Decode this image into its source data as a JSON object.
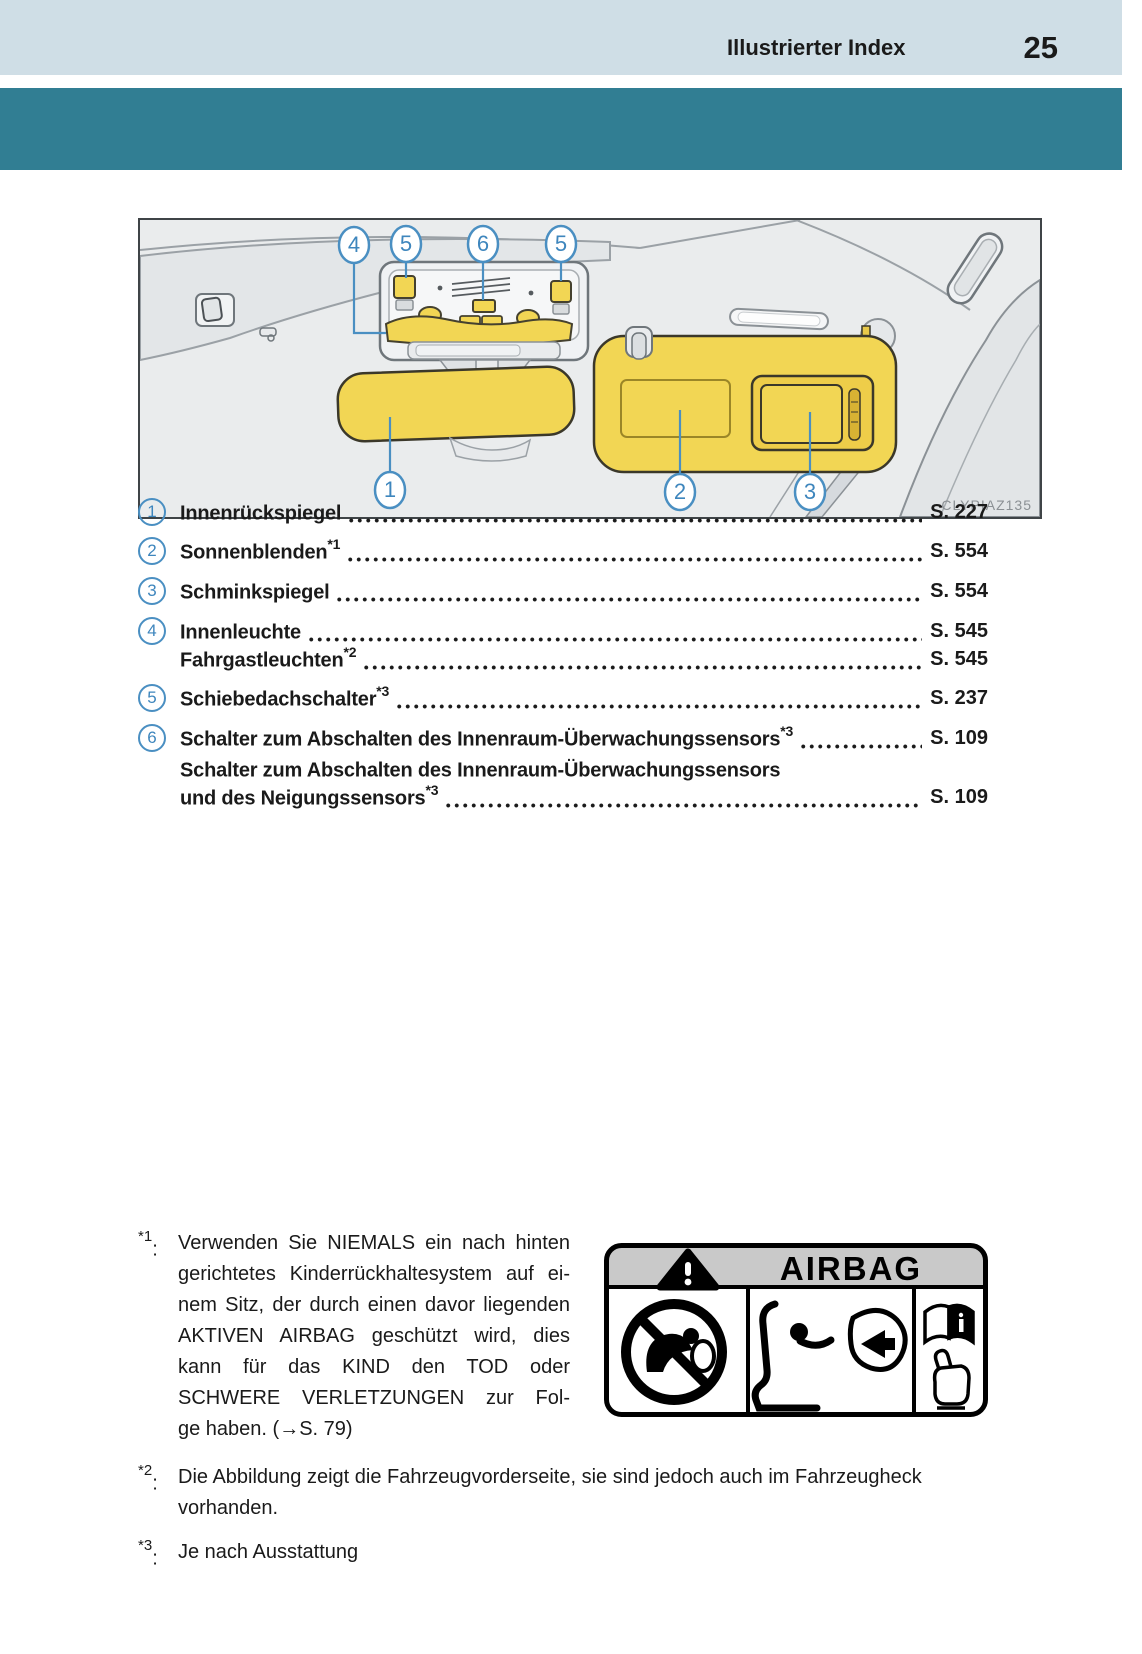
{
  "header": {
    "title": "Illustrierter Index",
    "page_number": "25"
  },
  "figure": {
    "code": "CLYPIAZ135",
    "callouts": {
      "c1": "1",
      "c2": "2",
      "c3": "3",
      "c4": "4",
      "c5a": "5",
      "c6": "6",
      "c5b": "5"
    }
  },
  "index": {
    "rows": [
      {
        "num": "1",
        "label": "Innenrückspiegel",
        "sup": "",
        "page": "S. 227"
      },
      {
        "num": "2",
        "label": "Sonnenblenden",
        "sup": "*1",
        "page": "S. 554"
      },
      {
        "num": "3",
        "label": "Schminkspiegel",
        "sup": "",
        "page": "S. 554"
      },
      {
        "num": "4",
        "label": "Innenleuchte",
        "sup": "",
        "page": "S. 545"
      },
      {
        "num": "",
        "label": "Fahrgastleuchten",
        "sup": "*2",
        "page": "S. 545"
      },
      {
        "num": "5",
        "label": "Schiebedachschalter",
        "sup": "*3",
        "page": "S. 237"
      },
      {
        "num": "6",
        "label": "Schalter zum Abschalten des Innenraum-Überwachungssensors",
        "sup": "*3",
        "page": "S. 109"
      },
      {
        "num": "",
        "label": "Schalter zum Abschalten des Innenraum-Überwachungssensors",
        "sup": "",
        "page": ""
      },
      {
        "num": "",
        "label": "und des Neigungssensors",
        "sup": "*3",
        "page": "S. 109"
      }
    ]
  },
  "footnotes": [
    {
      "sup": "*1",
      "colon": ":",
      "lines": [
        "Verwenden Sie NIEMALS ein nach hinten",
        "gerichtetes Kinderrückhaltesystem auf ei-",
        "nem Sitz, der durch einen davor liegenden",
        "AKTIVEN AIRBAG geschützt wird, dies",
        "kann für das KIND den TOD oder",
        "SCHWERE VERLETZUNGEN zur Fol-",
        "ge haben. (→S. 79)"
      ]
    },
    {
      "sup": "*2",
      "colon": ":",
      "lines": [
        "Die Abbildung zeigt die Fahrzeugvorderseite, sie sind jedoch auch im Fahrzeugheck",
        "vorhanden."
      ]
    },
    {
      "sup": "*3",
      "colon": ":",
      "lines": [
        "Je nach Ausstattung"
      ]
    }
  ],
  "airbag_label": {
    "title": "AIRBAG"
  },
  "colors": {
    "header_bg": "#cfdee6",
    "band_teal": "#317e93",
    "callout_blue": "#4a8fc2",
    "highlight_yellow": "#f2d654"
  }
}
